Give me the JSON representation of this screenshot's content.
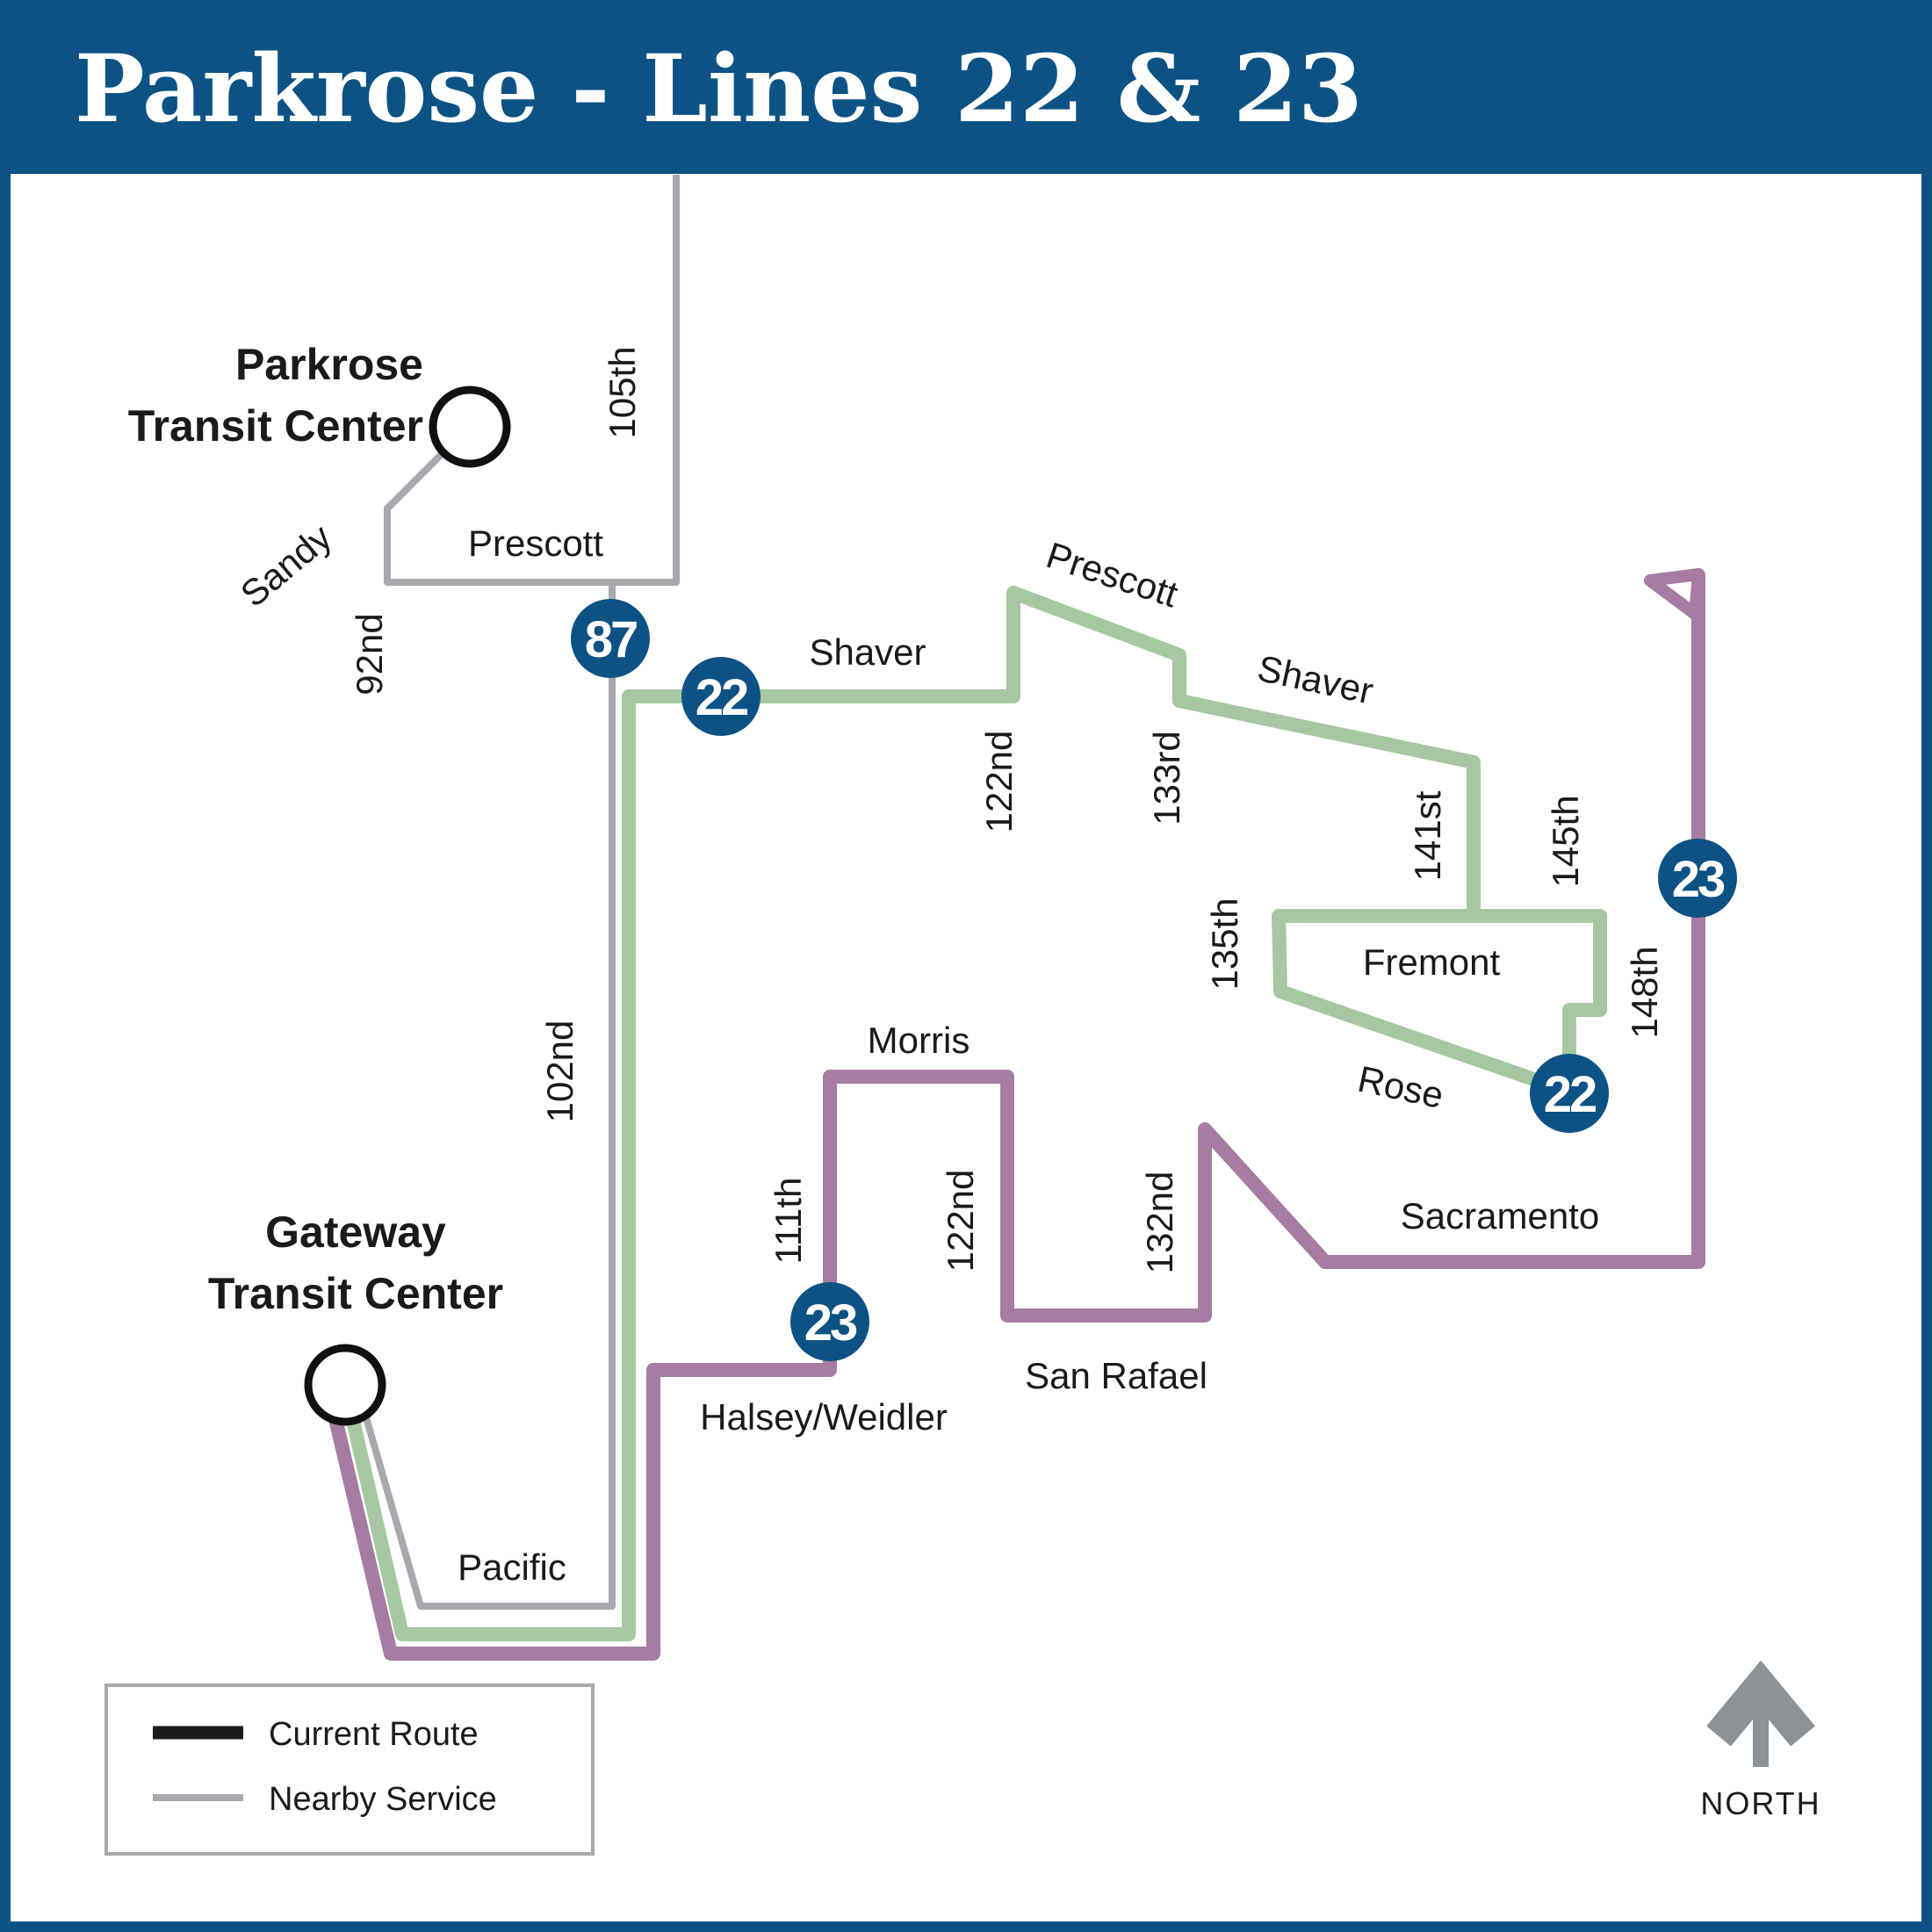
{
  "title": "Parkrose - Lines 22 & 23",
  "colors": {
    "banner_blue": "#0c5285",
    "badge_blue": "#0c5285",
    "route_22_green": "#a5c8a0",
    "route_23_purple": "#a87ba2",
    "nearby_service_gray": "#a7a9ac",
    "north_arrow_gray": "#8f9294"
  },
  "transit_centers": {
    "parkrose": {
      "line1": "Parkrose",
      "line2": "Transit Center"
    },
    "gateway": {
      "line1": "Gateway",
      "line2": "Transit Center"
    }
  },
  "badges": {
    "b87": "87",
    "b22_west": "22",
    "b22_east": "22",
    "b23_west": "23",
    "b23_east": "23"
  },
  "streets": {
    "s105th": "105th",
    "prescott_nearby": "Prescott",
    "sandy": "Sandy",
    "s92nd": "92nd",
    "s102nd": "102nd",
    "shaver_west": "Shaver",
    "prescott_22": "Prescott",
    "shaver_east": "Shaver",
    "s122nd_north": "122nd",
    "s133rd": "133rd",
    "s141st": "141st",
    "s145th": "145th",
    "s135th": "135th",
    "fremont": "Fremont",
    "rose": "Rose",
    "s148th": "148th",
    "sacramento": "Sacramento",
    "morris": "Morris",
    "s111th": "111th",
    "s122nd_south": "122nd",
    "s132nd": "132nd",
    "san_rafael": "San Rafael",
    "halsey_weidler": "Halsey/Weidler",
    "pacific": "Pacific"
  },
  "legend": {
    "current_route": "Current Route",
    "nearby_service": "Nearby Service"
  },
  "compass": {
    "north": "NORTH"
  }
}
